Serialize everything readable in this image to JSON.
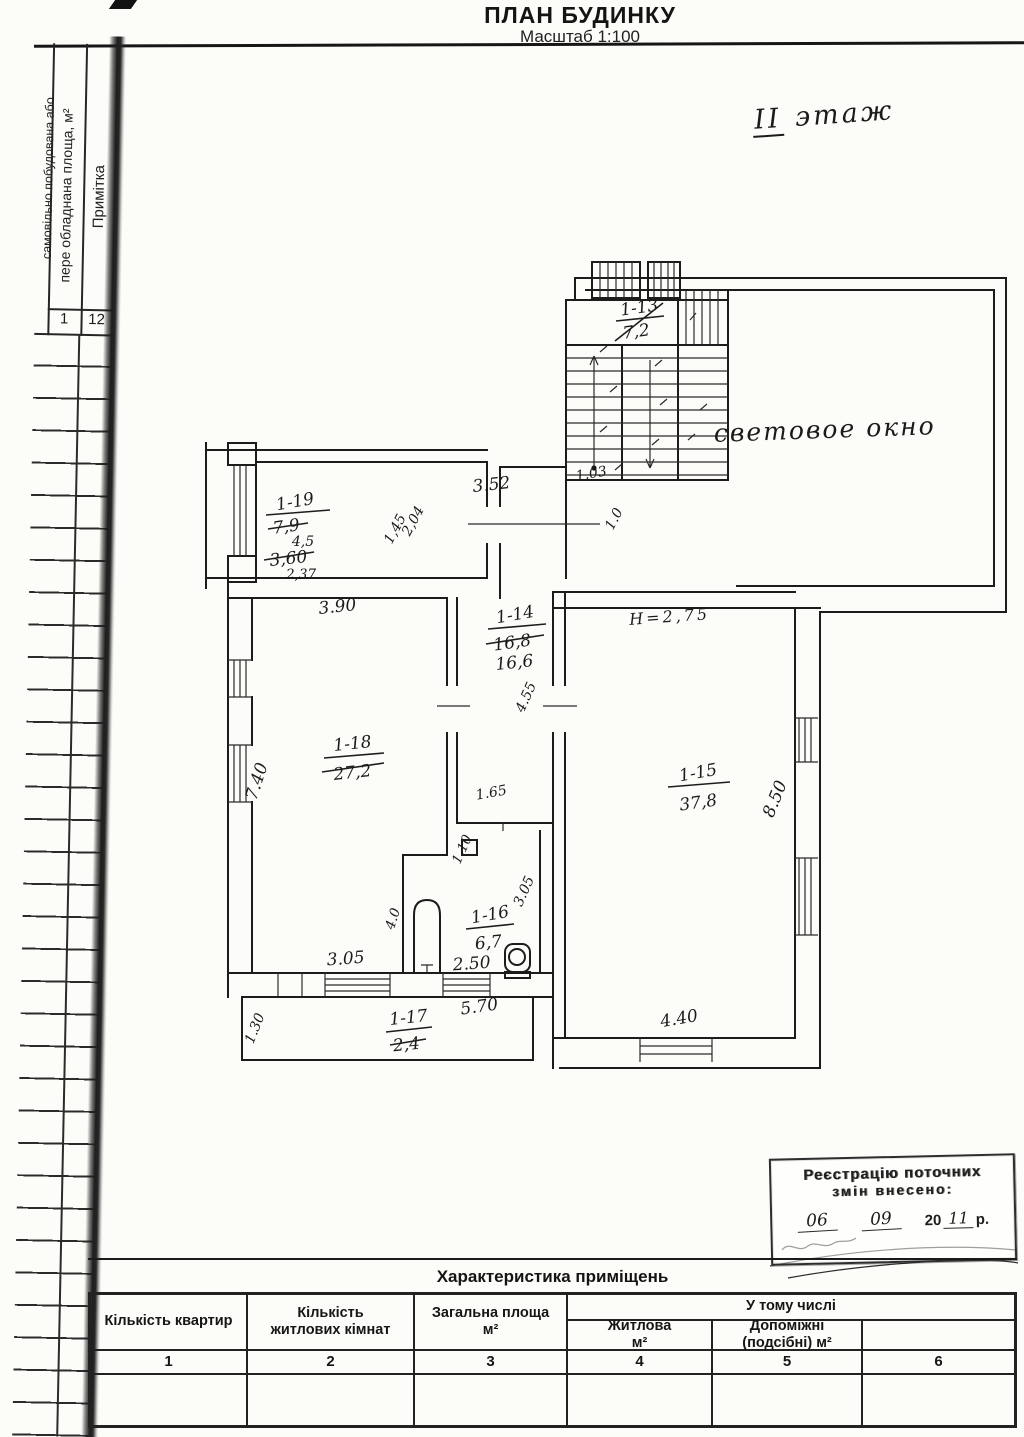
{
  "page": {
    "title": "ПЛАН БУДИНКУ",
    "subtitle": "Масштаб 1:100",
    "floor_roman": "ІІ",
    "floor_word": "этаж",
    "light_well": "световое окно"
  },
  "side_table": {
    "vertical_header_line1": "самовільно побудована або",
    "vertical_header_line2": "пере обладнана площа, м²",
    "vertical_header_note": "Примітка",
    "col_num_left": "1",
    "col_num_right": "12"
  },
  "plan": {
    "stairs": {
      "label": "1-13",
      "area": "7,2"
    },
    "r19": {
      "label": "1-19",
      "old1": "7,9",
      "mid": "4,5",
      "old2": "3,60",
      "cur": "2,37"
    },
    "r18": {
      "label": "1-18",
      "area": "27,2"
    },
    "r14": {
      "label": "1-14",
      "old": "16,8",
      "cur": "16,6"
    },
    "r15": {
      "label": "1-15",
      "area": "37,8",
      "height": "Н=2,75"
    },
    "r16": {
      "label": "1-16",
      "area": "6,7"
    },
    "r17": {
      "label": "1-17",
      "area": "2,4"
    },
    "dims": {
      "corridor_top": "3.52",
      "stairs_bottom": "1.03",
      "r19_door": "1.0",
      "r19_diag_a": "1,45",
      "r19_diag_b": "2,04",
      "r18_top": "3.90",
      "r18_left": "7.40",
      "r18_bottom": "3.05",
      "r14_side": "4.55",
      "r14_bottom": "1.65",
      "r15_right": "8.50",
      "r15_bottom": "4.40",
      "r16_nook": "1.10",
      "r16_side": "3.05",
      "r16_bottom": "2.50",
      "r16_left": "4.0",
      "r17_top": "5.70",
      "r17_left": "1.30"
    }
  },
  "stamp": {
    "line1": "Реєстрацію поточних",
    "line2": "змін внесено:",
    "day": "06",
    "month": "09",
    "century": "20",
    "year": "11",
    "suffix": "р."
  },
  "bottom_table": {
    "title": "Характеристика приміщень",
    "group_header": "У тому числі",
    "col1": "Кількість квартир",
    "col2_line1": "Кількість",
    "col2_line2": "житлових кімнат",
    "col3_line1": "Загальна площа",
    "col3_line2": "м²",
    "col4_line1": "Житлова",
    "col4_line2": "м²",
    "col5_line1": "Допоміжні",
    "col5_line2": "(подсібні) м²",
    "nums": [
      "1",
      "2",
      "3",
      "4",
      "5",
      "6"
    ]
  }
}
